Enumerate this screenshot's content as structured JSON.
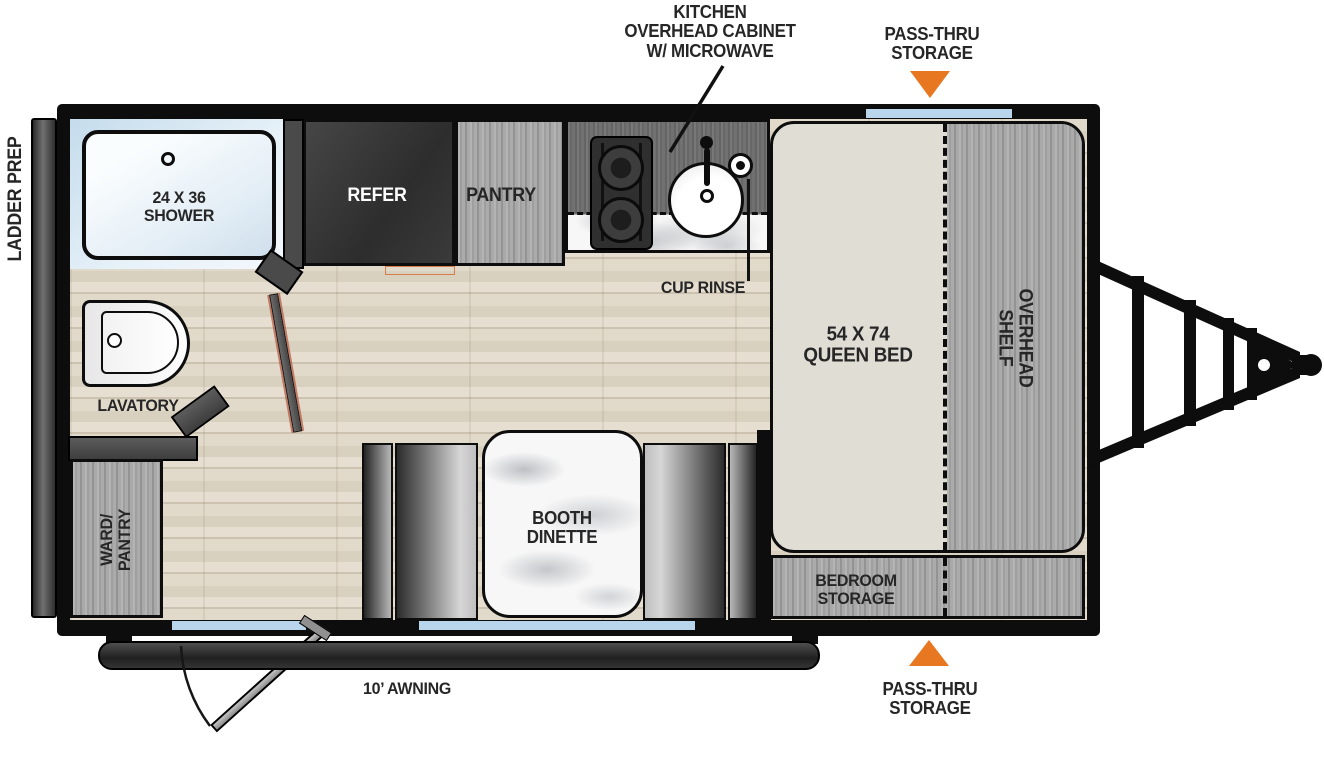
{
  "title": "Travel trailer floorplan diagram",
  "colors": {
    "accent_orange": "#e87722",
    "window_blue": "#b9d5eb",
    "wall_black": "#0d0d0d",
    "floor_wood": "#dcd4c5",
    "cabinet_gray": "#a7a7a7",
    "door_edge_red": "#b5492f"
  },
  "labels": {
    "kitchen_overhead": "KITCHEN\nOVERHEAD CABINET\nW/ MICROWAVE",
    "pass_thru_top": "PASS-THRU\nSTORAGE",
    "pass_thru_bottom": "PASS-THRU\nSTORAGE",
    "ladder_prep": "LADDER PREP",
    "shower": "24 X 36\nSHOWER",
    "refer": "REFER",
    "pantry": "PANTRY",
    "cup_rinse": "CUP RINSE",
    "queen_bed": "54 X 74\nQUEEN BED",
    "overhead_shelf": "OVERHEAD\nSHELF",
    "lavatory": "LAVATORY",
    "ward_pantry": "WARD/\nPANTRY",
    "booth_dinette": "BOOTH\nDINETTE",
    "bedroom_storage": "BEDROOM\nSTORAGE",
    "awning": "10’ AWNING"
  }
}
